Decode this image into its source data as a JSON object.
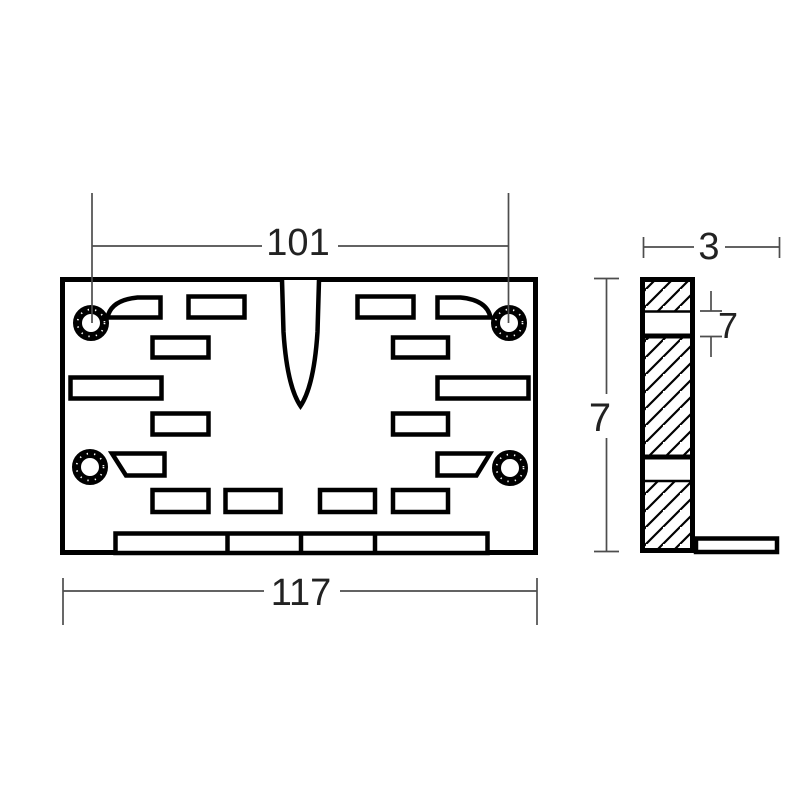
{
  "drawing": {
    "type": "technical-part-drawing",
    "views": {
      "front": "plate-front-view",
      "side": "l-section-side-view"
    },
    "dimensions": {
      "hole_spacing": "101",
      "overall_width": "117",
      "side_width": "3",
      "side_height": "7",
      "side_band": "7"
    },
    "colors": {
      "background": "#ffffff",
      "outline": "#000000",
      "dimension_line": "#4d4d4d",
      "dimension_text": "#222222",
      "fill": "#ffffff"
    }
  }
}
